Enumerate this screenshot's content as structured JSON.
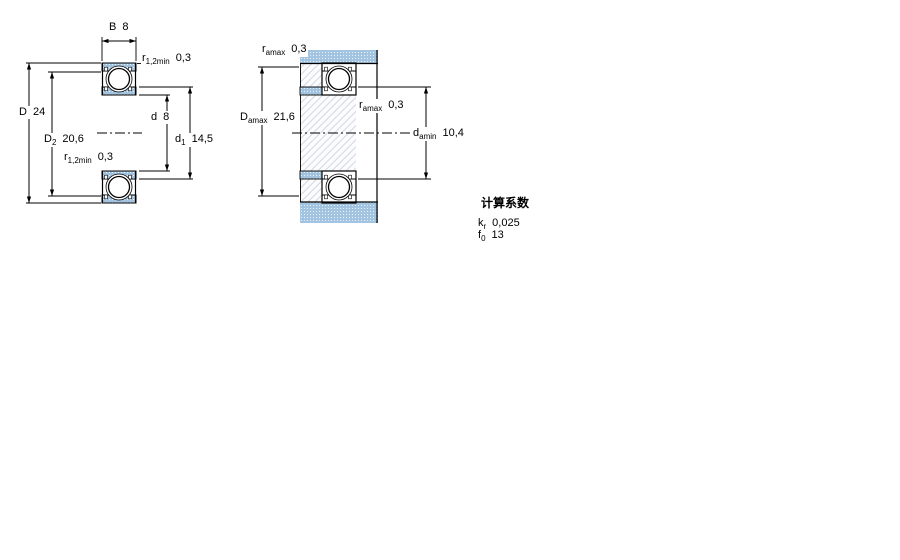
{
  "labels": {
    "B": {
      "sym": "B",
      "val": "8"
    },
    "D": {
      "sym": "D",
      "val": "24"
    },
    "D2": {
      "sym": "D",
      "sub": "2",
      "val": "20,6"
    },
    "d": {
      "sym": "d",
      "val": "8"
    },
    "d1": {
      "sym": "d",
      "sub": "1",
      "val": "14,5"
    },
    "r12_top": {
      "sym": "r",
      "sub": "1,2min",
      "val": "0,3"
    },
    "r12_bot": {
      "sym": "r",
      "sub": "1,2min",
      "val": "0,3"
    },
    "ra_top": {
      "sym": "r",
      "sub": "amax",
      "val": "0,3"
    },
    "Da": {
      "sym": "D",
      "sub": "amax",
      "val": "21,6"
    },
    "ra_mid": {
      "sym": "r",
      "sub": "amax",
      "val": "0,3"
    },
    "da": {
      "sym": "d",
      "sub": "amin",
      "val": "10,4"
    }
  },
  "factors": {
    "title": "计算系数",
    "rows": [
      {
        "sym": "k",
        "sub": "r",
        "val": "0,025"
      },
      {
        "sym": "f",
        "sub": "0",
        "val": "13"
      }
    ]
  },
  "colors": {
    "ring_fill": "#a3c4e0",
    "ring_dot": "#e9f2fa",
    "hatch_bg": "#fbfcfd",
    "hatch_line": "#d3d8df",
    "outline": "#000000"
  }
}
